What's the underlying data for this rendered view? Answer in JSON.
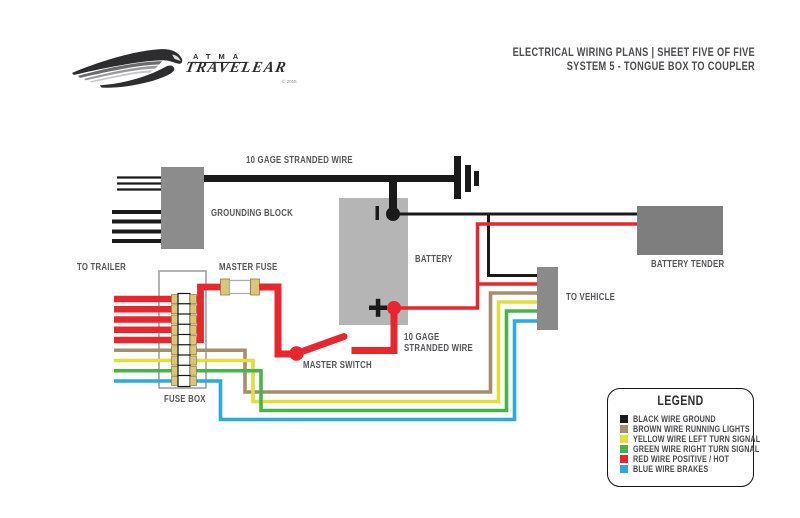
{
  "header": {
    "brand_top": "ATMA",
    "brand_main": "TRAVELEAR",
    "brand_copyright": "© 2015",
    "title_line1": "ELECTRICAL WIRING PLANS | SHEET FIVE OF FIVE",
    "title_line2": "SYSTEM 5 - TONGUE BOX TO COUPLER"
  },
  "diagram": {
    "labels": {
      "gage_wire_top": "10 GAGE STRANDED WIRE",
      "grounding_block": "GROUNDING BLOCK",
      "to_trailer": "TO TRAILER",
      "master_fuse": "MASTER FUSE",
      "battery": "BATTERY",
      "battery_tender": "BATTERY TENDER",
      "to_vehicle": "TO VEHICLE",
      "gage_wire_bottom_line1": "10 GAGE",
      "gage_wire_bottom_line2": "STRANDED WIRE",
      "master_switch": "MASTER SWITCH",
      "fuse_box": "FUSE BOX",
      "battery_positive": "+",
      "battery_negative": "−"
    }
  },
  "legend": {
    "title": "LEGEND",
    "items": [
      {
        "color_key": "black",
        "label": "BLACK WIRE GROUND"
      },
      {
        "color_key": "brown",
        "label": "BROWN WIRE RUNNING LIGHTS"
      },
      {
        "color_key": "yellow",
        "label": "YELLOW WIRE LEFT TURN SIGNAL"
      },
      {
        "color_key": "green",
        "label": "GREEN WIRE RIGHT TURN SIGNAL"
      },
      {
        "color_key": "red",
        "label": "RED WIRE POSITIVE / HOT"
      },
      {
        "color_key": "blue",
        "label": "BLUE WIRE BRAKES"
      }
    ]
  },
  "colors": {
    "black": "#1a1a1a",
    "brown": "#a58e6e",
    "yellow": "#e2de3a",
    "green": "#46b549",
    "red": "#e8262d",
    "blue": "#29abe2",
    "block_gray": "#8c8c8c",
    "battery_gray": "#b5b5b5",
    "tender_gray": "#7e7e7e",
    "connector_gray": "#8a8a8a",
    "fuse_cap": "#d9c67b",
    "label_text": "#55565a"
  }
}
